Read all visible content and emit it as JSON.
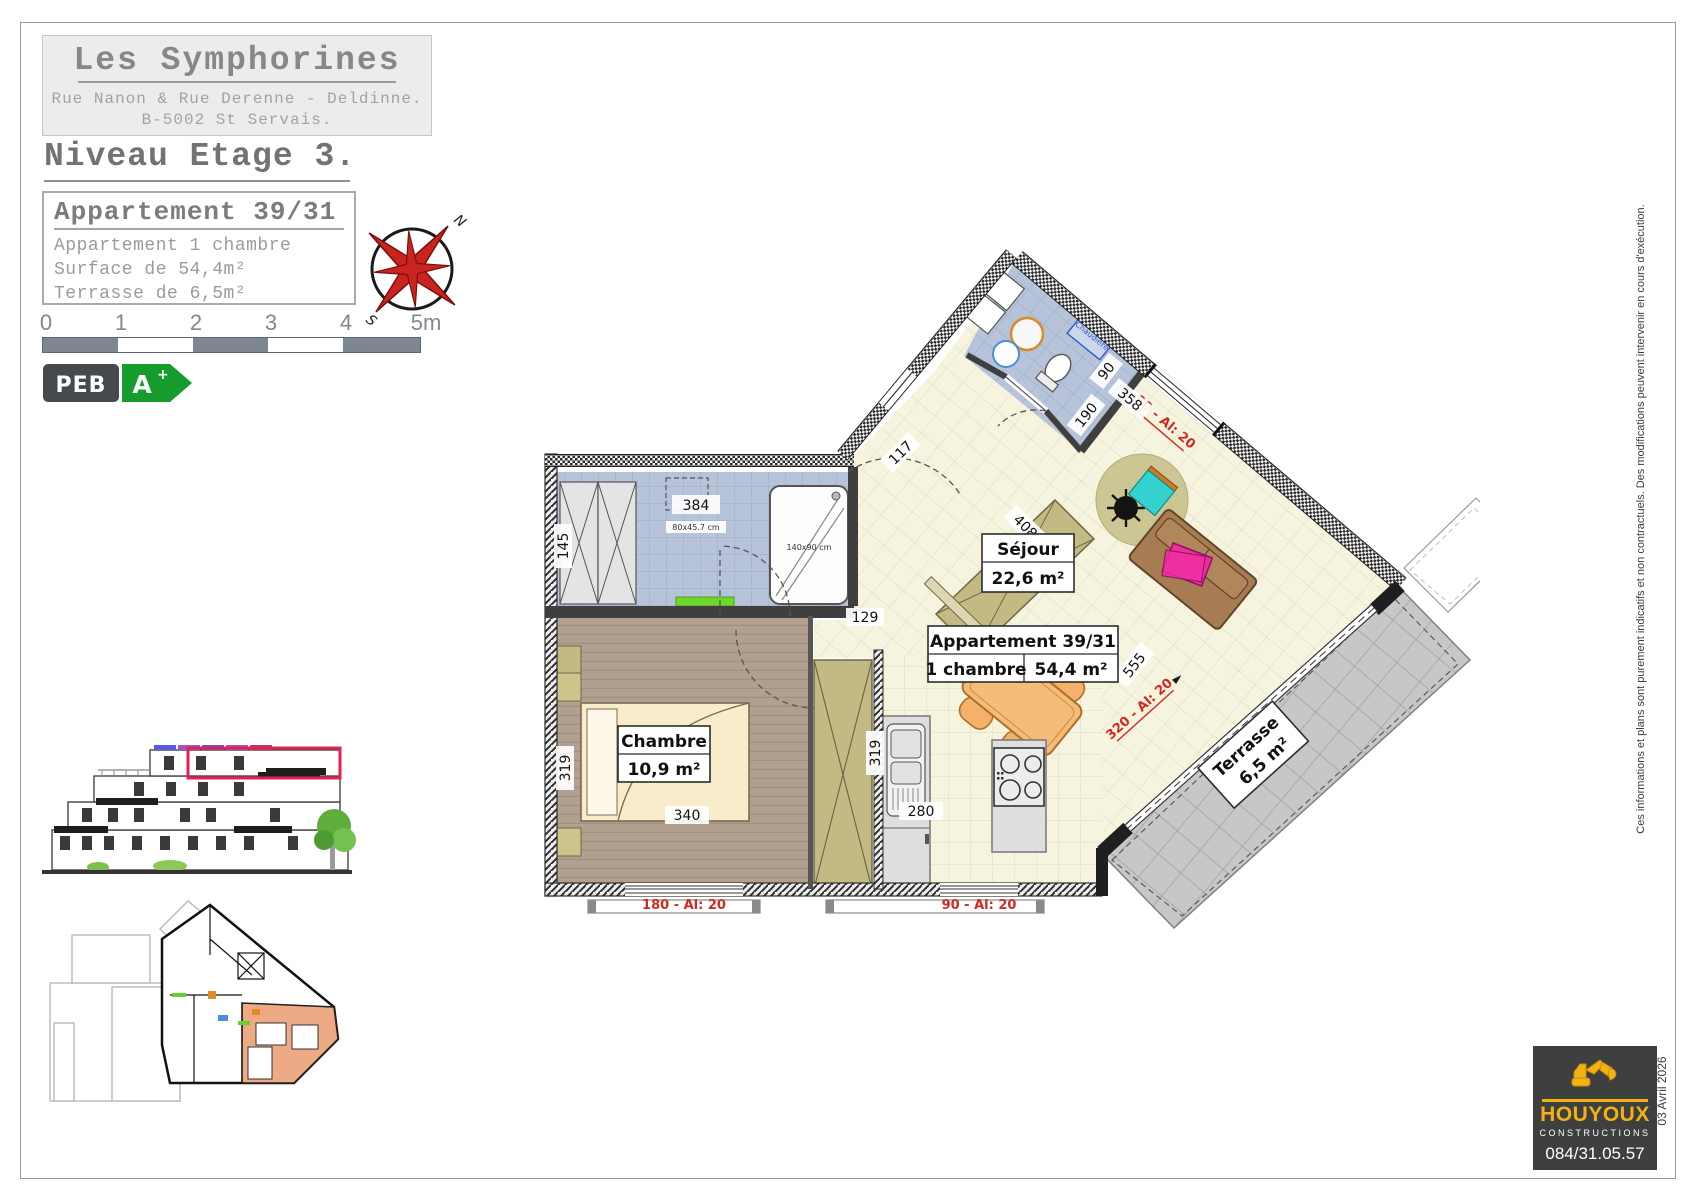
{
  "header": {
    "project": "Les Symphorines",
    "address_line1": "Rue Nanon & Rue Derenne - Deldinne.",
    "address_line2": "B-5002 St Servais.",
    "level": "Niveau Etage 3."
  },
  "apartment_card": {
    "title": "Appartement 39/31",
    "line1": "Appartement 1 chambre",
    "line2": "Surface de 54,4m²",
    "line3": "Terrasse de 6,5m²"
  },
  "compass": {
    "north": "N",
    "south": "S"
  },
  "scale_bar": {
    "ticks": [
      "0",
      "1",
      "2",
      "3",
      "4",
      "5m"
    ]
  },
  "peb": {
    "label": "PEB",
    "grade": "A",
    "plus": "+"
  },
  "plan": {
    "rooms": {
      "sejour": {
        "name": "Séjour",
        "area": "22,6 m²"
      },
      "chambre": {
        "name": "Chambre",
        "area": "10,9 m²"
      },
      "terrasse": {
        "name": "Terrasse",
        "area": "6,5 m²"
      }
    },
    "tag": {
      "title": "Appartement 39/31",
      "rooms": "1 chambre",
      "area": "54,4 m²"
    },
    "dims": {
      "d145": "145",
      "d384": "384",
      "d319bed": "319",
      "d340": "340",
      "d129": "129",
      "d117": "117",
      "d90": "90",
      "d190": "190",
      "d358": "358",
      "d408": "408",
      "d555": "555",
      "d319kit": "319",
      "d280": "280"
    },
    "windows": {
      "w_top": "90 - Al: 20",
      "w_terrace": "320 - Al: 20",
      "w_bed": "180 - Al: 20",
      "w_kitchen": "90 - Al: 20"
    },
    "annotations": {
      "shower": "140x90 cm",
      "sink": "80x45.7 cm",
      "boiler": "Chaudière"
    }
  },
  "footer": {
    "logo": {
      "name": "HOUYOUX",
      "sub": "CONSTRUCTIONS",
      "phone": "084/31.05.57"
    },
    "date": "03 Avril 2026",
    "disclaimer": "Ces informations et plans sont purement indicatifs et non contractuels.  Des modifications peuvent intervenir en cours d'exécution."
  }
}
